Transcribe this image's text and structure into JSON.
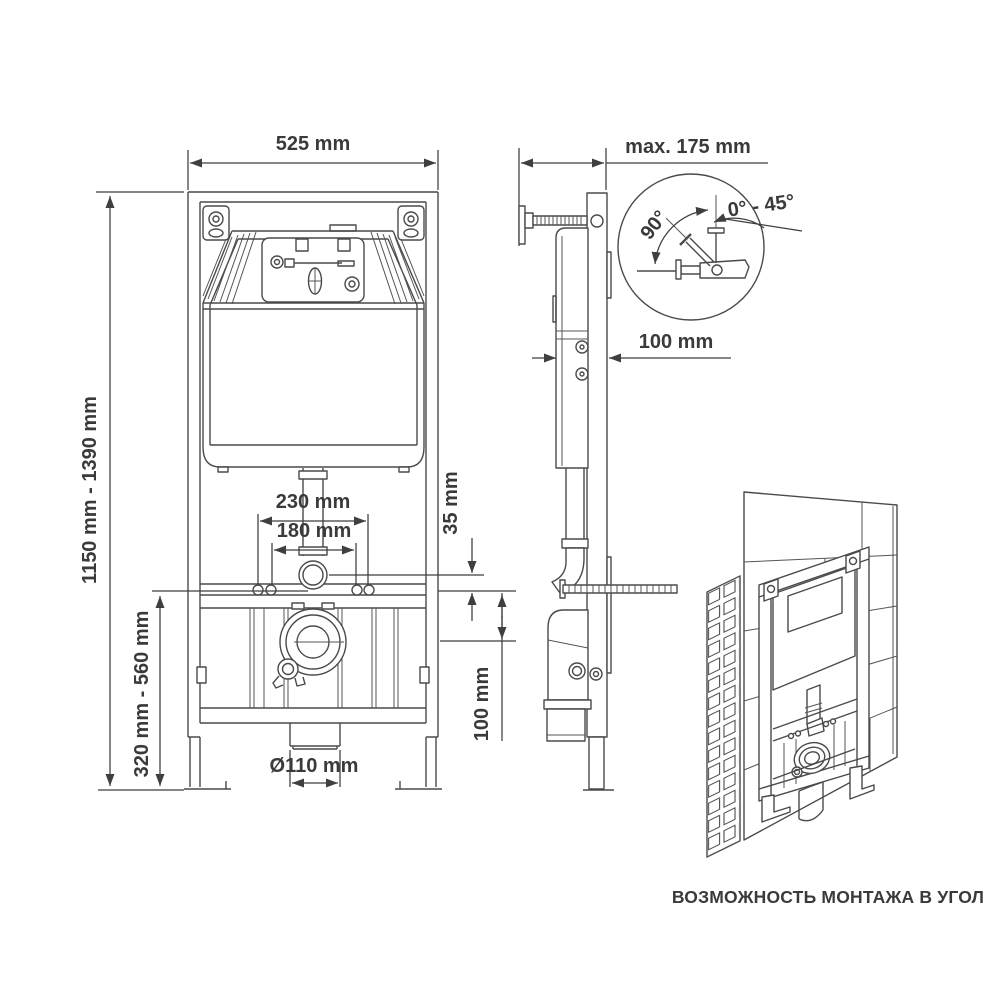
{
  "caption": "ВОЗМОЖНОСТЬ МОНТАЖА В УГОЛ",
  "dims": {
    "frame_width": "525 mm",
    "depth_max": "max. 175 mm",
    "height_range": "1150 mm - 1390 mm",
    "outlet_range": "320 mm - 560 mm",
    "holes_outer": "230 mm",
    "holes_inner": "180 mm",
    "flange_offset": "35 mm",
    "drain_height": "100 mm",
    "body_depth": "100 mm",
    "drain_diameter": "Ø110 mm",
    "angle_full": "90°",
    "angle_range": "0° - 45°"
  },
  "colors": {
    "line": "#4a4a4a",
    "text": "#3a3a3a",
    "background": "#ffffff"
  }
}
